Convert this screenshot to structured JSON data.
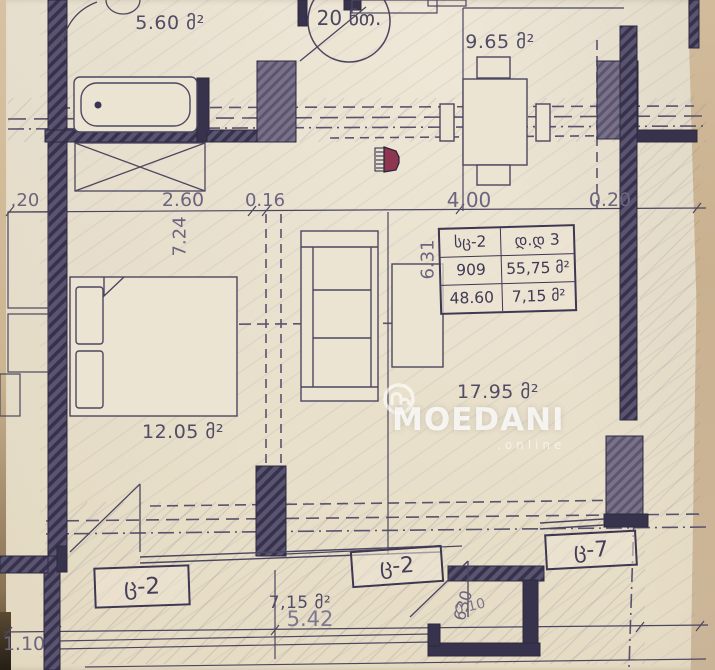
{
  "plan": {
    "unit_badge": "20 ნთ.",
    "areas": {
      "bathroom": "5.60 მ²",
      "kitchen": "9.65 მ²",
      "bedroom": "12.05 მ²",
      "living": "17.95 მ²",
      "balcony": "7,15 მ²"
    },
    "dimensions": {
      "left_020": ".20",
      "d_260": "2.60",
      "d_016": "0.16",
      "d_400": "4.00",
      "right_020": "0.20",
      "v_724": "7.24",
      "v_631": "6.31",
      "d_542": "5.42",
      "d_110": "1.10",
      "nook_630": "630",
      "nook_010": "0.10"
    },
    "window_tags": {
      "left": "ც-2",
      "middle": "ც-2",
      "right": "ც-7"
    },
    "info_table": {
      "r1c1": "სც-2",
      "r1c2": "დ.დ 3",
      "r2c1": "909",
      "r2c2": "55,75 მ²",
      "r3c1": "48.60 მ²",
      "r3c2": "7,15 მ²"
    },
    "watermark": {
      "brand": "MOEDANI",
      "domain": ".online"
    },
    "colors": {
      "paper": "#eae2cf",
      "wall": "#57516c",
      "ink": "#4c4660",
      "accent_red": "#8e3550",
      "photo_edge": "#c9b190"
    }
  }
}
